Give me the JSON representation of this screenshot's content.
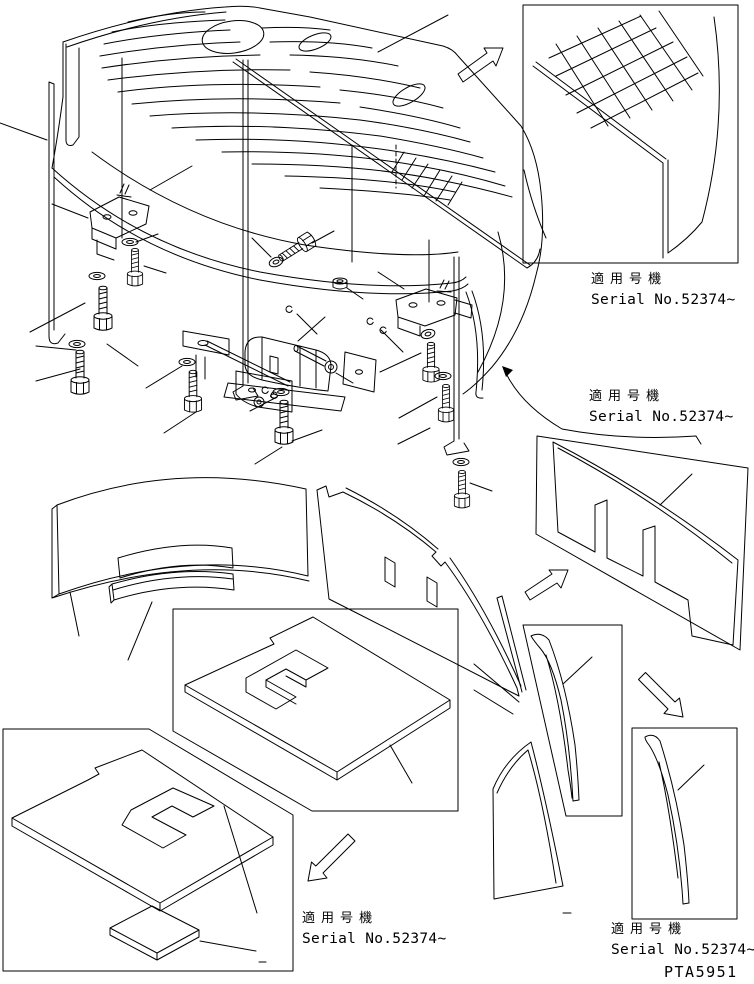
{
  "page": {
    "background": "#ffffff",
    "ink": "#000000"
  },
  "serial_notes": [
    {
      "jp": "適用号機",
      "en": "Serial No.52374~"
    },
    {
      "jp": "適用号機",
      "en": "Serial No.52374~"
    },
    {
      "jp": "適用号機",
      "en": "Serial No.52374~"
    },
    {
      "jp": "適用号機",
      "en": "Serial No.52374~"
    }
  ],
  "drawing_code": "PTA5951"
}
